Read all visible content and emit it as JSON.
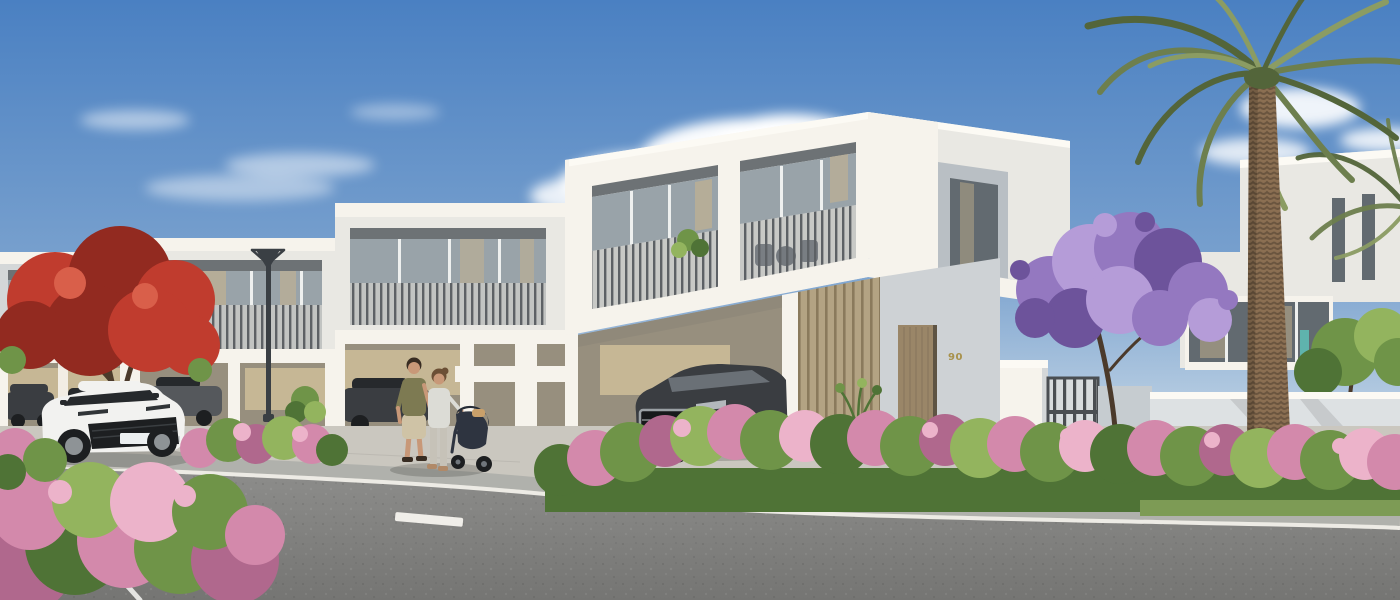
{
  "scene": {
    "description": "Sunny 3D architectural render of a row of modern white two-storey townhouses along a curved street, with pink bougainvillea hedges, a purple jacaranda tree, a red flowering tree, a tall date palm, a white SUV driving past, cars parked in carports, and a couple walking with a baby stroller.",
    "house_number": "90",
    "objects": [
      "blue-sky",
      "clouds",
      "townhouse-row",
      "balconies-with-slat-railings",
      "carports",
      "white-suv-on-road",
      "dark-suv-in-carport",
      "parked-cars",
      "man-walking",
      "woman-walking",
      "baby-stroller",
      "street-lamp",
      "date-palm-tree",
      "jacaranda-tree",
      "red-flowering-tree",
      "bougainvillea-hedges",
      "front-door",
      "entry-gate",
      "boundary-wall",
      "road-with-lane-markings",
      "sidewalk"
    ]
  },
  "palette": {
    "sky_top": "#4a80c2",
    "sky_mid": "#79a1ce",
    "sky_horizon": "#d6e3ec",
    "cloud": "#ffffff",
    "facade_sunlit": "#f6f3ec",
    "facade_cap": "#fcfaf4",
    "facade_white": "#e9e8e3",
    "facade_shade": "#d4d7d8",
    "facade_dark": "#b9bfc4",
    "soffit": "#6d7275",
    "glass_cool": "#99a3a9",
    "glass_warm": "#c8b48e",
    "glass_dark": "#626a70",
    "mullion": "#eef0ef",
    "railing": "#a2a6a8",
    "slat": "#5d6165",
    "wood_tan": "#b3a383",
    "wood_dark": "#8a7a5c",
    "door_wood": "#9a8668",
    "door_edge": "#5e5444",
    "wall_beige": "#c6b795",
    "wall_beige_shade": "#a39c8b",
    "carport_shade": "#978f7e",
    "boundary_wall": "#dde1e3",
    "boundary_wall_shade": "#c6ccd0",
    "wall_entry": "#ced2d5",
    "gate": "#4a4e52",
    "gate_gap": "#d8dcde",
    "number_gold": "#a8914b",
    "pavement": "#cac7bf",
    "pavement_line": "#b7b4ac",
    "sidewalk": "#b0b1ac",
    "curb": "#edebe5",
    "road": "#8e8e8c",
    "road_deep": "#757573",
    "marking": "#eaeae7",
    "hedge_green": "#6f9448",
    "hedge_dark": "#4f7336",
    "hedge_light": "#93b45e",
    "grass": "#7d9b55",
    "pink": "#d389ab",
    "pink_dark": "#b0688d",
    "pink_light": "#ecb3ca",
    "red": "#c03c2e",
    "red_dark": "#922a20",
    "red_light": "#d95f4a",
    "purple": "#9478c0",
    "purple_light": "#b59cd8",
    "purple_dark": "#6d539b",
    "palm": "#6d7f4e",
    "palm_dark": "#53653a",
    "palm_light": "#8b9c63",
    "trunk": "#8b6f52",
    "trunk_shade": "#6b553f",
    "bark": "#5f4c38",
    "branch": "#4b3a2b",
    "car_white": "#f2f2f0",
    "car_white_shade": "#d0d3d4",
    "car_dark": "#3a3d41",
    "car_gray": "#55585c",
    "car_silver": "#babdbf",
    "window_tint": "#26292c",
    "glass_reflect": "#70767c",
    "chrome": "#9aa0a4",
    "tire": "#1d1f21",
    "rim": "#8e9396",
    "plate": "#eceff0",
    "skin": "#c89878",
    "hair_dark": "#382c22",
    "hair_brown": "#6b4f35",
    "shirt_olive": "#7d7a52",
    "shorts": "#cfc3a6",
    "top_light": "#dcdcd6",
    "pants": "#c6c2b8",
    "shoe_brown": "#b08968",
    "stroller": "#2e3440",
    "stroller_canopy": "#262c36",
    "bag_tan": "#c9a06a",
    "lamp": "#3a3f44",
    "teal_accent": "#5fb3ad",
    "shadow": "rgba(40,42,38,0.22)",
    "shadow_soft": "rgba(40,42,38,0.12)"
  }
}
